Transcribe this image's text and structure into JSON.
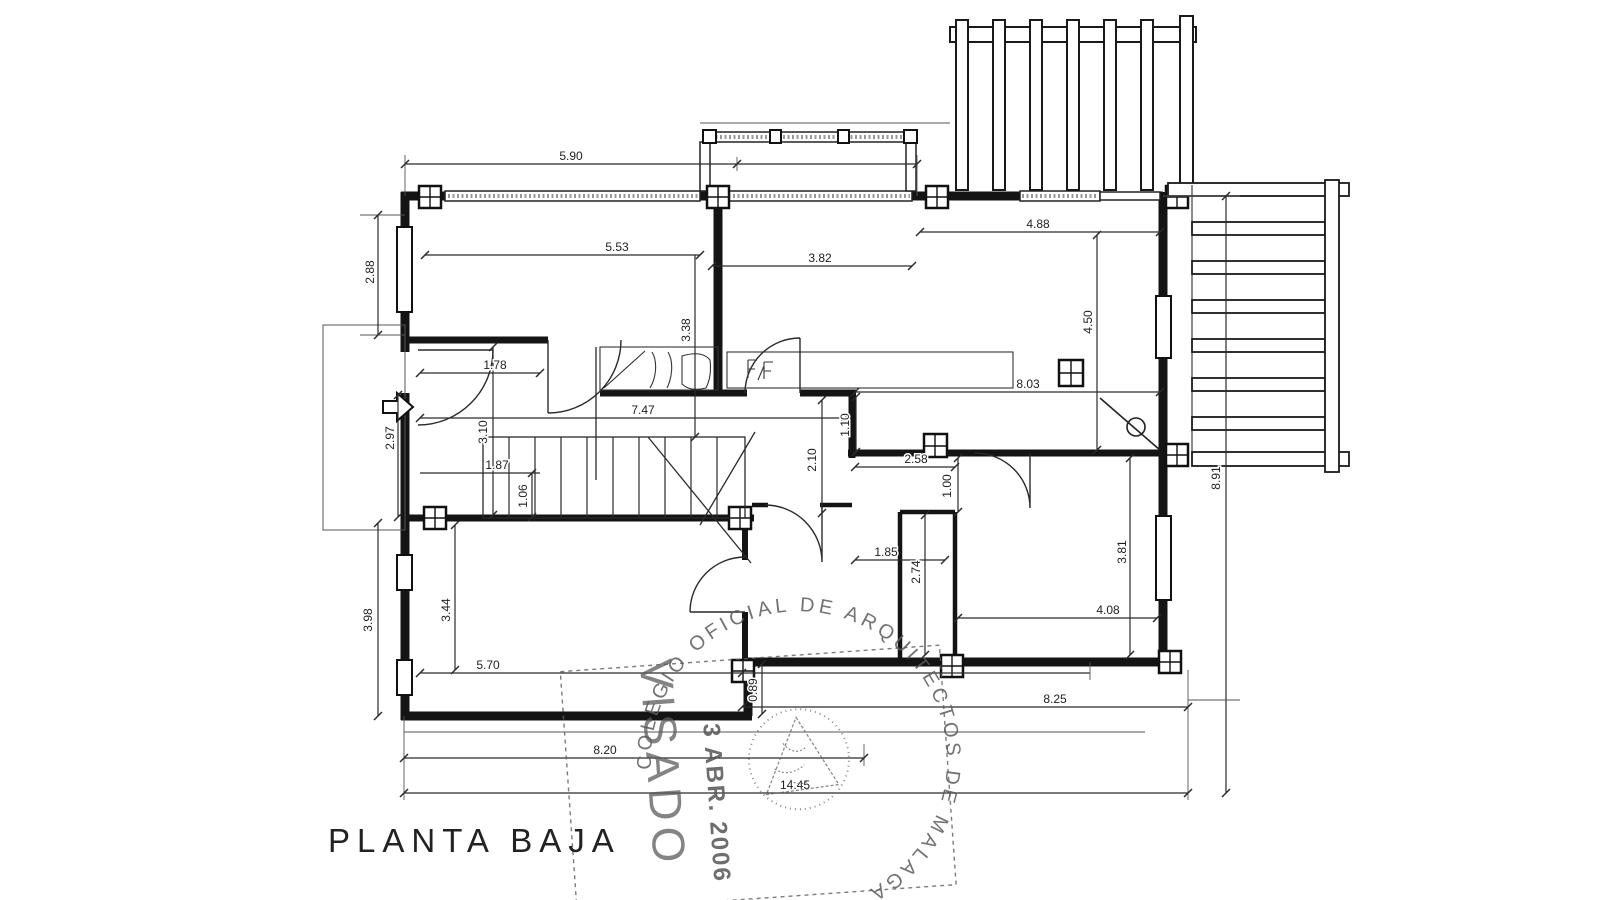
{
  "title": "PLANTA BAJA",
  "dims": {
    "d590": "5.90",
    "d288": "2.88",
    "d553": "5.53",
    "d338": "3.38",
    "d382": "3.82",
    "d488": "4.88",
    "d450": "4.50",
    "d178": "1.78",
    "d747": "7.47",
    "d110": "1.10",
    "d803": "8.03",
    "d297": "2.97",
    "d310": "3.10",
    "d187": "1.87",
    "d106": "1.06",
    "d210": "2.10",
    "d258": "2.58",
    "d100": "1.00",
    "d185": "1.85",
    "d274": "2.74",
    "d381": "3.81",
    "d408": "4.08",
    "d344": "3.44",
    "d570": "5.70",
    "d398": "3.98",
    "d089": "0.89",
    "d825": "8.25",
    "d820": "8.20",
    "d1445": "14.45",
    "d891": "8.91"
  },
  "stamp": {
    "arc_text": "COLEGIO OFICIAL DE ARQUITECTOS DE MALAGA",
    "visado": "VISADO",
    "date": "3 ABR. 2006"
  }
}
